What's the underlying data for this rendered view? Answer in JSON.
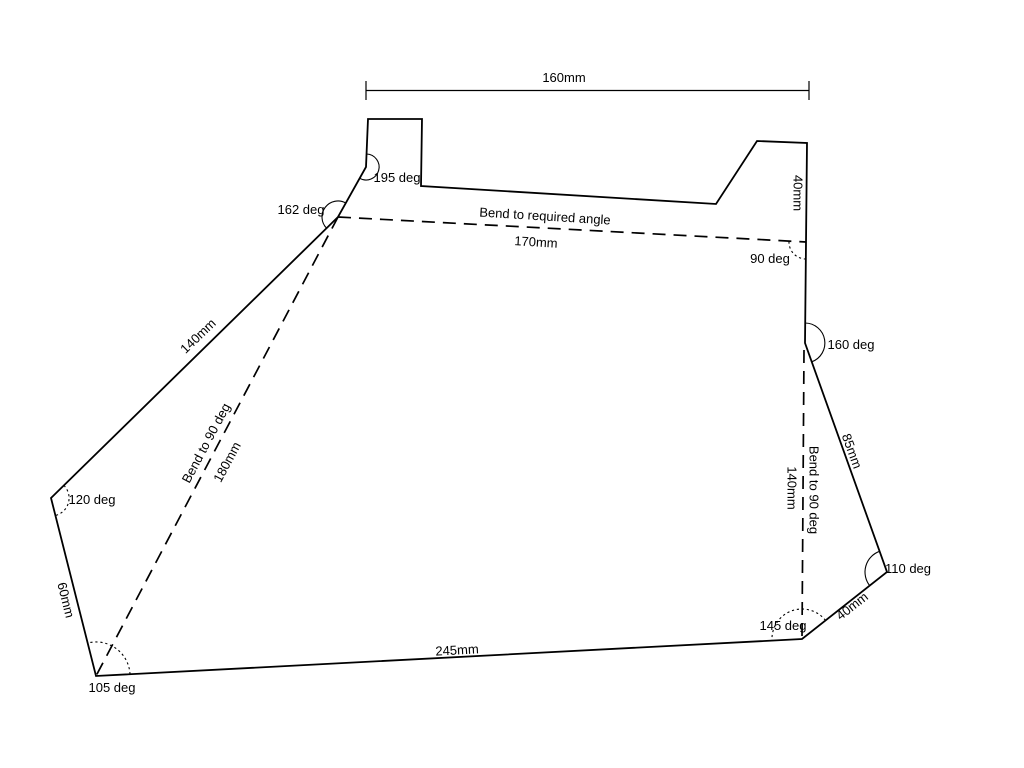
{
  "drawing": {
    "type": "sheet-metal-flat-pattern",
    "background_color": "#ffffff",
    "line_color": "#000000",
    "dimension_labels": {
      "overall_width": "160mm",
      "right_tab_height": "40mm",
      "top_bend_length": "170mm",
      "left_edge_length": "140mm",
      "left_bend_length": "180mm",
      "right_edge_length": "85mm",
      "right_bend_length": "140mm",
      "corner_edge_length": "40mm",
      "bottom_edge_length": "245mm",
      "lower_left_edge_length": "60mm"
    },
    "angle_labels": {
      "angle_195": "195 deg",
      "angle_162": "162 deg",
      "angle_90": "90 deg",
      "angle_160": "160 deg",
      "angle_110": "110 deg",
      "angle_145": "145 deg",
      "angle_105": "105 deg",
      "angle_120": "120 deg"
    },
    "bend_instructions": {
      "top": "Bend to required angle",
      "left": "Bend to 90 deg",
      "right": "Bend to 90 deg"
    }
  }
}
